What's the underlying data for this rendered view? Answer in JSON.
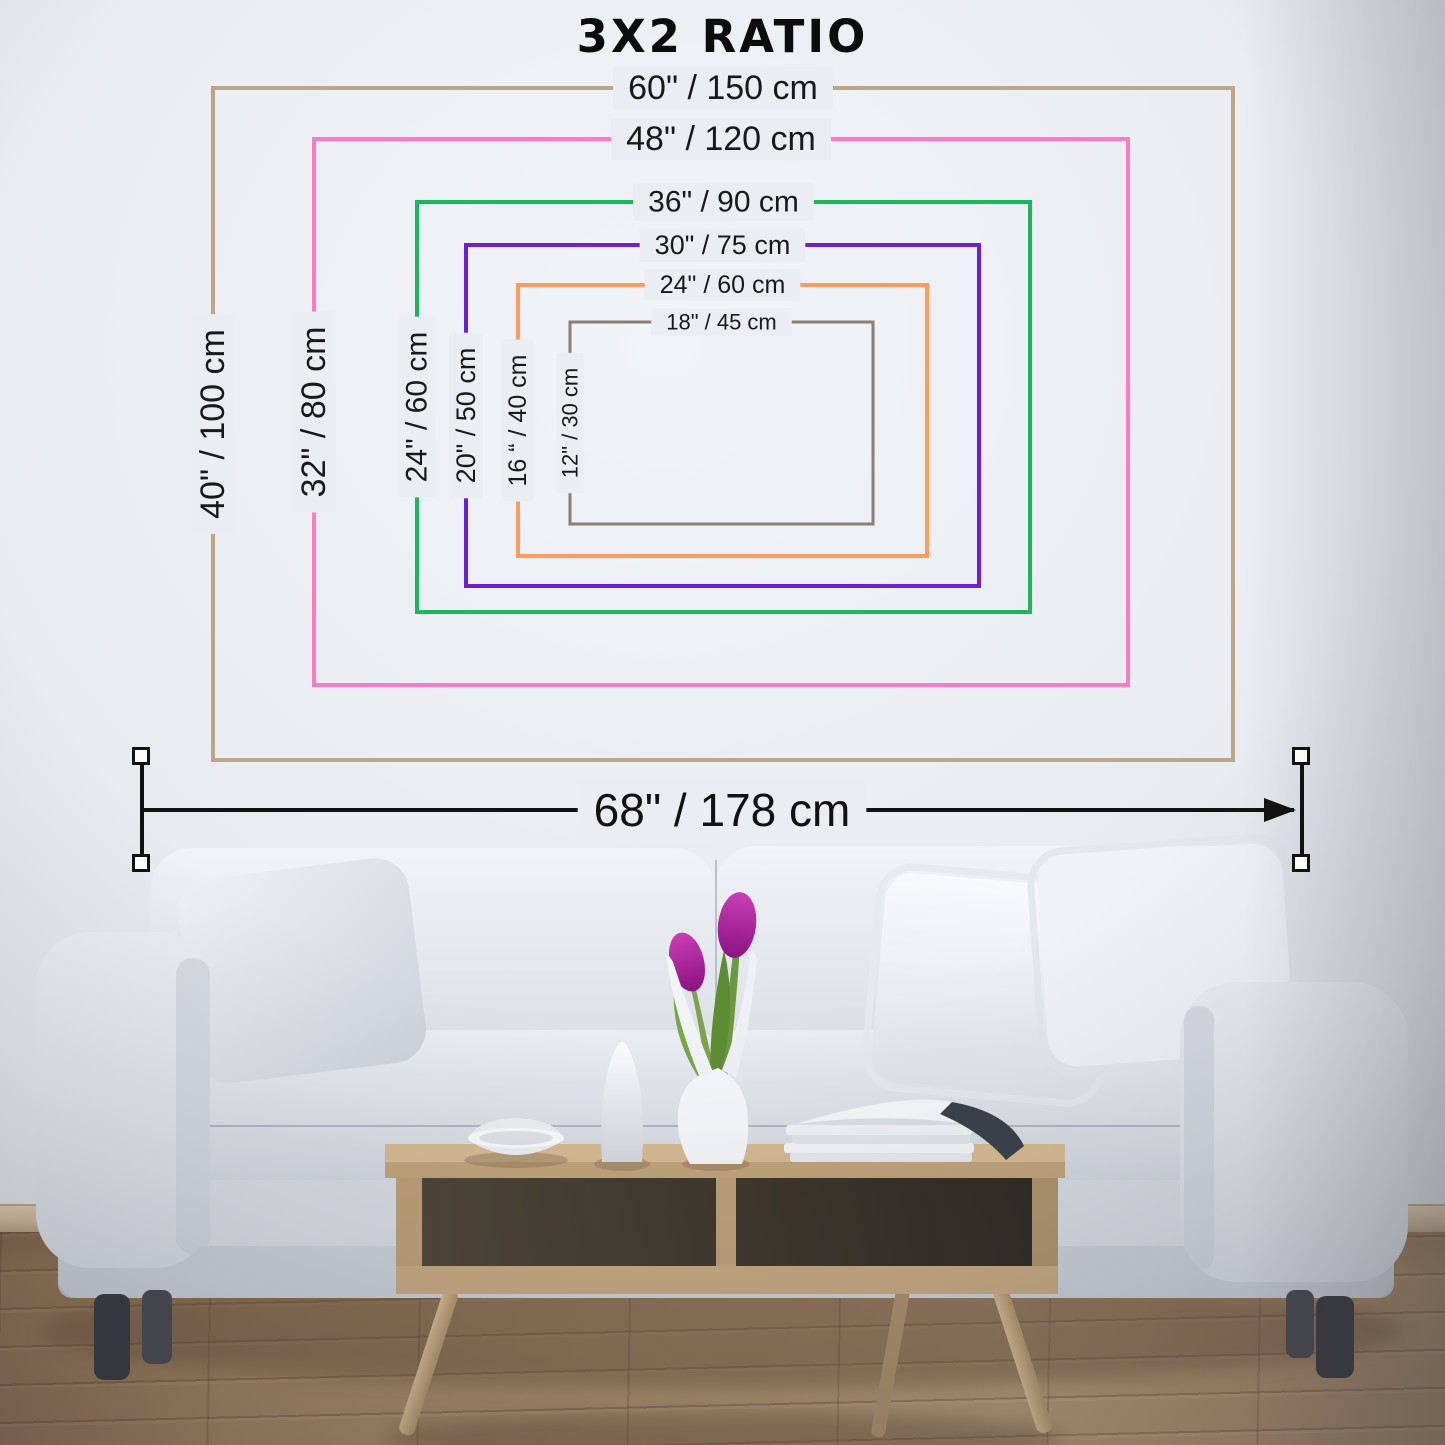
{
  "title": "3X2 RATIO",
  "size_chart": {
    "ratio": "3:2",
    "sizes": [
      {
        "name": "60x40",
        "width_label": "60\" / 150 cm",
        "height_label": "40\" / 100 cm",
        "width_in": 60,
        "height_in": 40,
        "width_cm": 150,
        "height_cm": 100,
        "color": "#BDA588"
      },
      {
        "name": "48x32",
        "width_label": "48\" / 120 cm",
        "height_label": "32\" / 80 cm",
        "width_in": 48,
        "height_in": 32,
        "width_cm": 120,
        "height_cm": 80,
        "color": "#FF7AC3"
      },
      {
        "name": "36x24",
        "width_label": "36\" / 90 cm",
        "height_label": "24\" / 60 cm",
        "width_in": 36,
        "height_in": 24,
        "width_cm": 90,
        "height_cm": 60,
        "color": "#19B85E"
      },
      {
        "name": "30x20",
        "width_label": "30\" / 75 cm",
        "height_label": "20\" / 50 cm",
        "width_in": 30,
        "height_in": 20,
        "width_cm": 75,
        "height_cm": 50,
        "color": "#6B1EDE"
      },
      {
        "name": "24x16",
        "width_label": "24\" / 60 cm",
        "height_label": "16 “ / 40 cm",
        "width_in": 24,
        "height_in": 16,
        "width_cm": 60,
        "height_cm": 40,
        "color": "#FF9C59"
      },
      {
        "name": "18x12",
        "width_label": "18\" / 45 cm",
        "height_label": "12\" / 30 cm",
        "width_in": 18,
        "height_in": 12,
        "width_cm": 45,
        "height_cm": 30,
        "color": "#8A7F70"
      }
    ]
  },
  "wall_measurement": {
    "label": "68\" / 178 cm",
    "inches": 68,
    "cm": 178
  },
  "colors": {
    "label_text": "#191919",
    "dimension_line": "#121212",
    "wall_knockout": "#EAEDF2"
  }
}
